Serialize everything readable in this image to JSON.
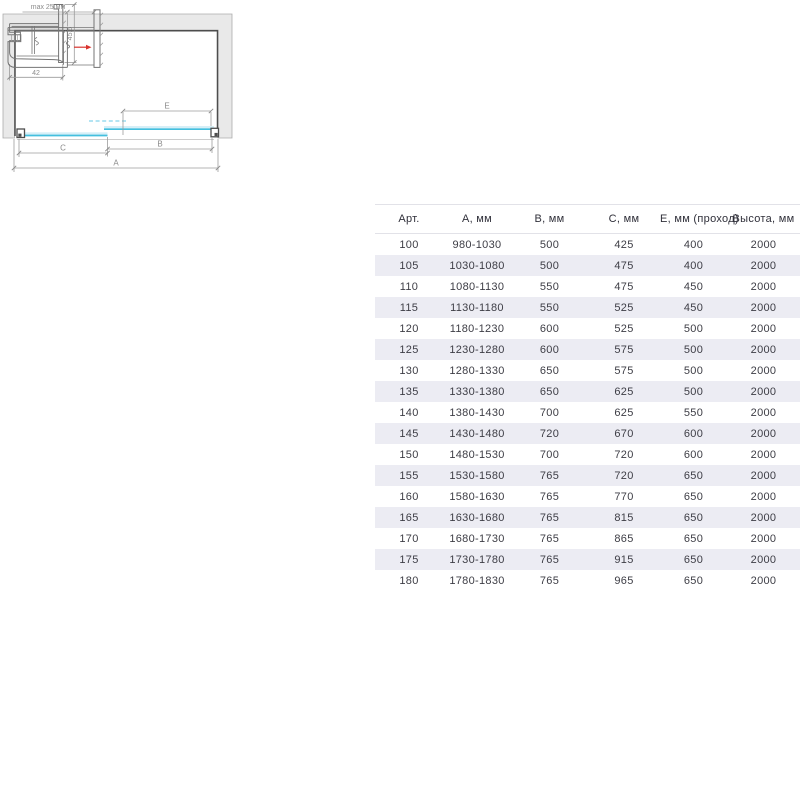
{
  "colors": {
    "glass": "#44bfde",
    "glass_light": "#d6eff7",
    "glass_dash": "#9adcef",
    "stripe": "#ececf3",
    "wall_fill": "#e9e9e9",
    "wall_stroke": "#acacac",
    "dark_line": "#4d4d4d",
    "profile_line": "#757575",
    "dim_line": "#9c9c9c",
    "dim_text": "#8b8b8b",
    "arrow_red": "#d9332e",
    "table_text": "#3d3d45",
    "table_border": "#e2e2e8"
  },
  "plan": {
    "labels": {
      "a": "А",
      "b": "В",
      "c": "С",
      "e": "Е"
    }
  },
  "profile_top": {
    "width_label": "42",
    "height_label": "45,5"
  },
  "profile_bottom": {
    "limit_label": "max 25 мм"
  },
  "table": {
    "headers": [
      "Арт.",
      "А, мм",
      "В, мм",
      "С, мм",
      "Е, мм (проход)",
      "Высота, мм"
    ],
    "rows": [
      [
        "100",
        "980-1030",
        "500",
        "425",
        "400",
        "2000"
      ],
      [
        "105",
        "1030-1080",
        "500",
        "475",
        "400",
        "2000"
      ],
      [
        "110",
        "1080-1130",
        "550",
        "475",
        "450",
        "2000"
      ],
      [
        "115",
        "1130-1180",
        "550",
        "525",
        "450",
        "2000"
      ],
      [
        "120",
        "1180-1230",
        "600",
        "525",
        "500",
        "2000"
      ],
      [
        "125",
        "1230-1280",
        "600",
        "575",
        "500",
        "2000"
      ],
      [
        "130",
        "1280-1330",
        "650",
        "575",
        "500",
        "2000"
      ],
      [
        "135",
        "1330-1380",
        "650",
        "625",
        "500",
        "2000"
      ],
      [
        "140",
        "1380-1430",
        "700",
        "625",
        "550",
        "2000"
      ],
      [
        "145",
        "1430-1480",
        "720",
        "670",
        "600",
        "2000"
      ],
      [
        "150",
        "1480-1530",
        "700",
        "720",
        "600",
        "2000"
      ],
      [
        "155",
        "1530-1580",
        "765",
        "720",
        "650",
        "2000"
      ],
      [
        "160",
        "1580-1630",
        "765",
        "770",
        "650",
        "2000"
      ],
      [
        "165",
        "1630-1680",
        "765",
        "815",
        "650",
        "2000"
      ],
      [
        "170",
        "1680-1730",
        "765",
        "865",
        "650",
        "2000"
      ],
      [
        "175",
        "1730-1780",
        "765",
        "915",
        "650",
        "2000"
      ],
      [
        "180",
        "1780-1830",
        "765",
        "965",
        "650",
        "2000"
      ]
    ]
  }
}
